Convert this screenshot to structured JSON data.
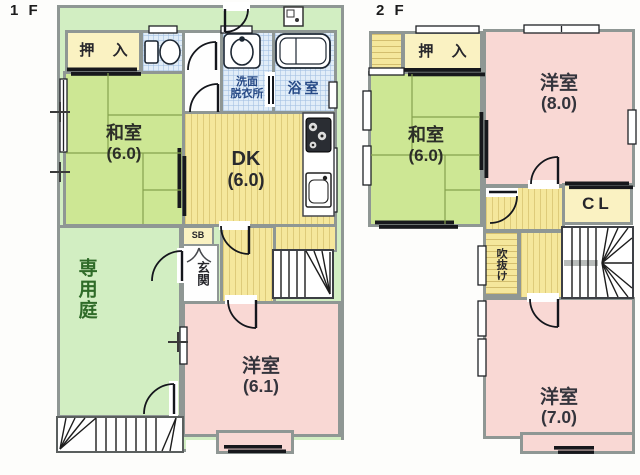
{
  "floor1": {
    "label": "1 F",
    "rooms": {
      "oshiire": {
        "label": "押 入"
      },
      "washitsu": {
        "name": "和室",
        "size": "(6.0)"
      },
      "dk": {
        "name": "DK",
        "size": "(6.0)"
      },
      "senmen": {
        "line1": "洗面",
        "line2": "脱衣所"
      },
      "yokushitsu": {
        "label": "浴室"
      },
      "sb": {
        "label": "SB"
      },
      "genkan": {
        "label": "玄関"
      },
      "senyoniwa": {
        "label": "専用庭"
      },
      "yoshitsu": {
        "name": "洋室",
        "size": "(6.1)"
      }
    }
  },
  "floor2": {
    "label": "2 F",
    "rooms": {
      "oshiire": {
        "label": "押 入"
      },
      "washitsu": {
        "name": "和室",
        "size": "(6.0)"
      },
      "yoshitsu8": {
        "name": "洋室",
        "size": "(8.0)"
      },
      "cl": {
        "label": "CL"
      },
      "fukinuke": {
        "label": "吹抜け"
      },
      "yoshitsu7": {
        "name": "洋室",
        "size": "(7.0)"
      }
    }
  },
  "colors": {
    "garden_green": "#d2eec2",
    "tatami_green": "#cde794",
    "dk_yellow": "#f5e79c",
    "western_pink": "#f9d8d4",
    "wet_blue": "#e1edf8",
    "closet_cream": "#faf2c2",
    "wall_gray": "#8f9794",
    "label_navy": "#274a86",
    "garden_label_green": "#2f6b28"
  }
}
